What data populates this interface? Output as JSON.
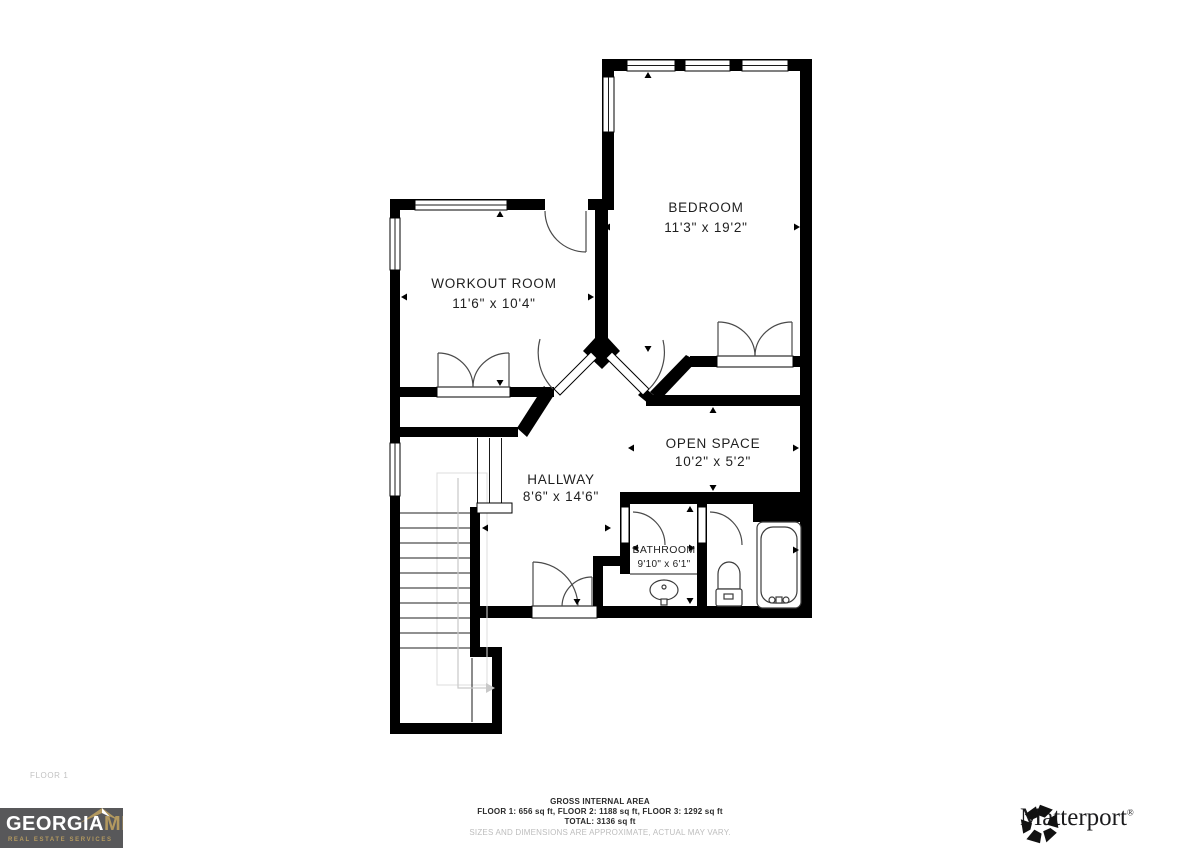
{
  "floor_tag": "FLOOR 1",
  "rooms": [
    {
      "name": "BEDROOM",
      "dims": "11'3\" x 19'2\""
    },
    {
      "name": "WORKOUT ROOM",
      "dims": "11'6\" x 10'4\""
    },
    {
      "name": "OPEN SPACE",
      "dims": "10'2\" x 5'2\""
    },
    {
      "name": "HALLWAY",
      "dims": "8'6\" x 14'6\""
    },
    {
      "name": "BATHROOM",
      "dims": "9'10\" x 6'1\""
    }
  ],
  "footer": {
    "title": "GROSS INTERNAL AREA",
    "line1": "FLOOR 1: 656 sq ft, FLOOR 2: 1188 sq ft, FLOOR 3: 1292 sq ft",
    "line2": "TOTAL: 3136 sq ft",
    "disclaimer": "SIZES AND DIMENSIONS ARE APPROXIMATE, ACTUAL MAY VARY."
  },
  "branding": {
    "georgia_mls": {
      "word1": "GEORGIA",
      "word2": "MLS",
      "tagline": "REAL ESTATE SERVICES",
      "bg_color": "#58585a",
      "gold_color": "#b3995f"
    },
    "matterport": {
      "label": "Matterport",
      "reg": "®"
    }
  },
  "colors": {
    "walls": "#000000",
    "door_arcs": "#4a4a4a",
    "dim_text_gray": "#bdbdbd"
  }
}
